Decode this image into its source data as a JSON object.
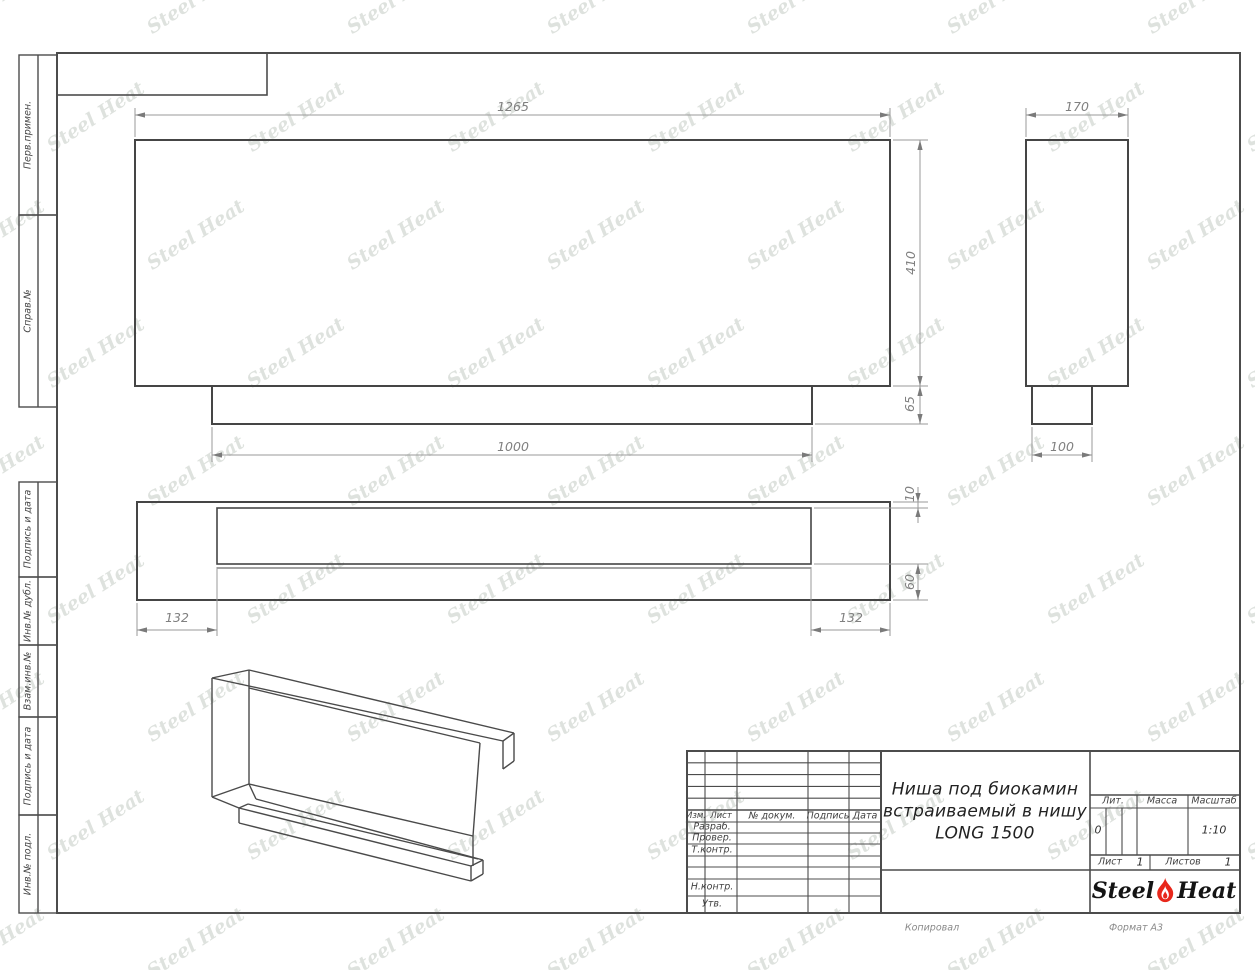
{
  "watermark": {
    "text": "Steel Heat"
  },
  "margin_labels": {
    "perv_primen": "Перв.примен.",
    "sprav_no": "Справ.№",
    "podpis_data_1": "Подпись и дата",
    "inv_dubl": "Инв.№ дубл.",
    "vzam_inv": "Взам.инв.№",
    "podpis_data_2": "Подпись и дата",
    "inv_podl": "Инв.№ подл."
  },
  "dimensions": {
    "front_width": "1265",
    "front_height": "410",
    "base_width": "1000",
    "base_height": "65",
    "side_depth": "170",
    "side_base_width": "100",
    "plan_offset_left": "132",
    "plan_offset_right": "132",
    "plan_gap_top": "10",
    "plan_gap_bottom": "60"
  },
  "title_block": {
    "col_izm": "Изм.",
    "col_list": "Лист",
    "col_doc": "№ докум.",
    "col_sign": "Подпись",
    "col_date": "Дата",
    "row_razrab": "Разраб.",
    "row_prover": "Провер.",
    "row_tkontr": "Т.контр.",
    "row_nkontr": "Н.контр.",
    "row_utv": "Утв.",
    "title_line1": "Ниша под биокамин",
    "title_line2": "встраиваемый в нишу",
    "title_line3": "LONG 1500",
    "lit_label": "Лит.",
    "lit_value": "0",
    "mass_label": "Масса",
    "scale_label": "Масштаб",
    "scale_value": "1:10",
    "sheet_label": "Лист",
    "sheet_value": "1",
    "sheets_label": "Листов",
    "sheets_value": "1"
  },
  "logo": {
    "steel": "Steel",
    "heat": "Heat"
  },
  "footer": {
    "kopiroval": "Копировал",
    "format": "Формат А3"
  }
}
